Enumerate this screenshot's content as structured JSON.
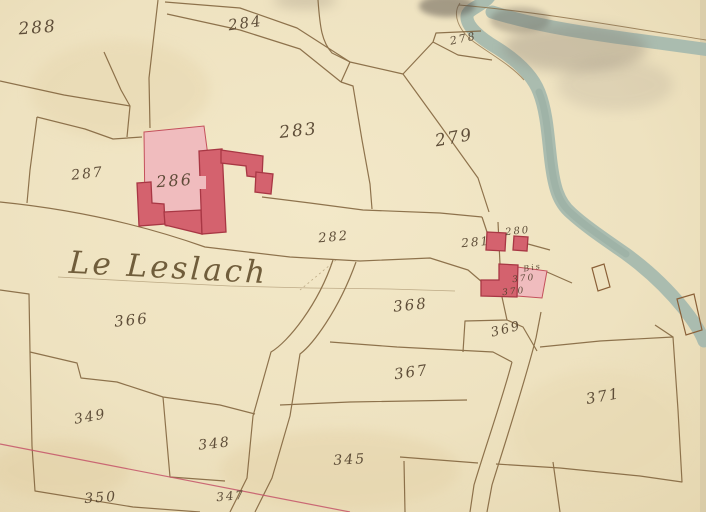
{
  "map": {
    "place_name": "Le Leslach",
    "colors": {
      "paper": "#eee2c0",
      "parcel_line": "#7d5f38",
      "river": "#a4b8ae",
      "building_dark": "#d4626e",
      "building_light": "#f0bcbe",
      "building_stroke": "#a83744",
      "red_survey_line": "#c45468",
      "label_ink": "#53422e"
    },
    "features": {
      "river": "unnamed watercourse, upper right, forking band",
      "bridges": 2,
      "buildings_pink": [
        "286",
        "281",
        "280",
        "370 Bis"
      ]
    },
    "parcel_labels": [
      {
        "text": "288",
        "x": 38,
        "y": 33,
        "size": 17,
        "rot": -4
      },
      {
        "text": "284",
        "x": 246,
        "y": 28,
        "size": 15,
        "rot": -8
      },
      {
        "text": "278",
        "x": 464,
        "y": 42,
        "size": 11,
        "rot": -12
      },
      {
        "text": "283",
        "x": 299,
        "y": 136,
        "size": 17,
        "rot": -6
      },
      {
        "text": "279",
        "x": 455,
        "y": 143,
        "size": 17,
        "rot": -10
      },
      {
        "text": "287",
        "x": 88,
        "y": 178,
        "size": 14,
        "rot": -6
      },
      {
        "text": "286",
        "x": 175,
        "y": 186,
        "size": 16,
        "rot": -4
      },
      {
        "text": "282",
        "x": 334,
        "y": 241,
        "size": 13,
        "rot": -5
      },
      {
        "text": "281",
        "x": 476,
        "y": 246,
        "size": 12,
        "rot": -5
      },
      {
        "text": "280",
        "x": 518,
        "y": 234,
        "size": 10,
        "rot": -6
      },
      {
        "text": "Bis",
        "x": 533,
        "y": 270,
        "size": 8,
        "rot": -10
      },
      {
        "text": "370",
        "x": 524,
        "y": 281,
        "size": 9,
        "rot": -6
      },
      {
        "text": "370",
        "x": 514,
        "y": 294,
        "size": 9,
        "rot": -6
      },
      {
        "text": "366",
        "x": 132,
        "y": 325,
        "size": 15,
        "rot": -6
      },
      {
        "text": "368",
        "x": 411,
        "y": 310,
        "size": 15,
        "rot": -6
      },
      {
        "text": "369",
        "x": 507,
        "y": 333,
        "size": 13,
        "rot": -14
      },
      {
        "text": "367",
        "x": 412,
        "y": 377,
        "size": 15,
        "rot": -8
      },
      {
        "text": "371",
        "x": 604,
        "y": 401,
        "size": 15,
        "rot": -10
      },
      {
        "text": "349",
        "x": 91,
        "y": 421,
        "size": 14,
        "rot": -10
      },
      {
        "text": "348",
        "x": 215,
        "y": 448,
        "size": 14,
        "rot": -6
      },
      {
        "text": "345",
        "x": 350,
        "y": 464,
        "size": 14,
        "rot": -3
      },
      {
        "text": "350",
        "x": 101,
        "y": 502,
        "size": 14,
        "rot": -4
      },
      {
        "text": "347",
        "x": 231,
        "y": 500,
        "size": 12,
        "rot": -5
      }
    ]
  }
}
